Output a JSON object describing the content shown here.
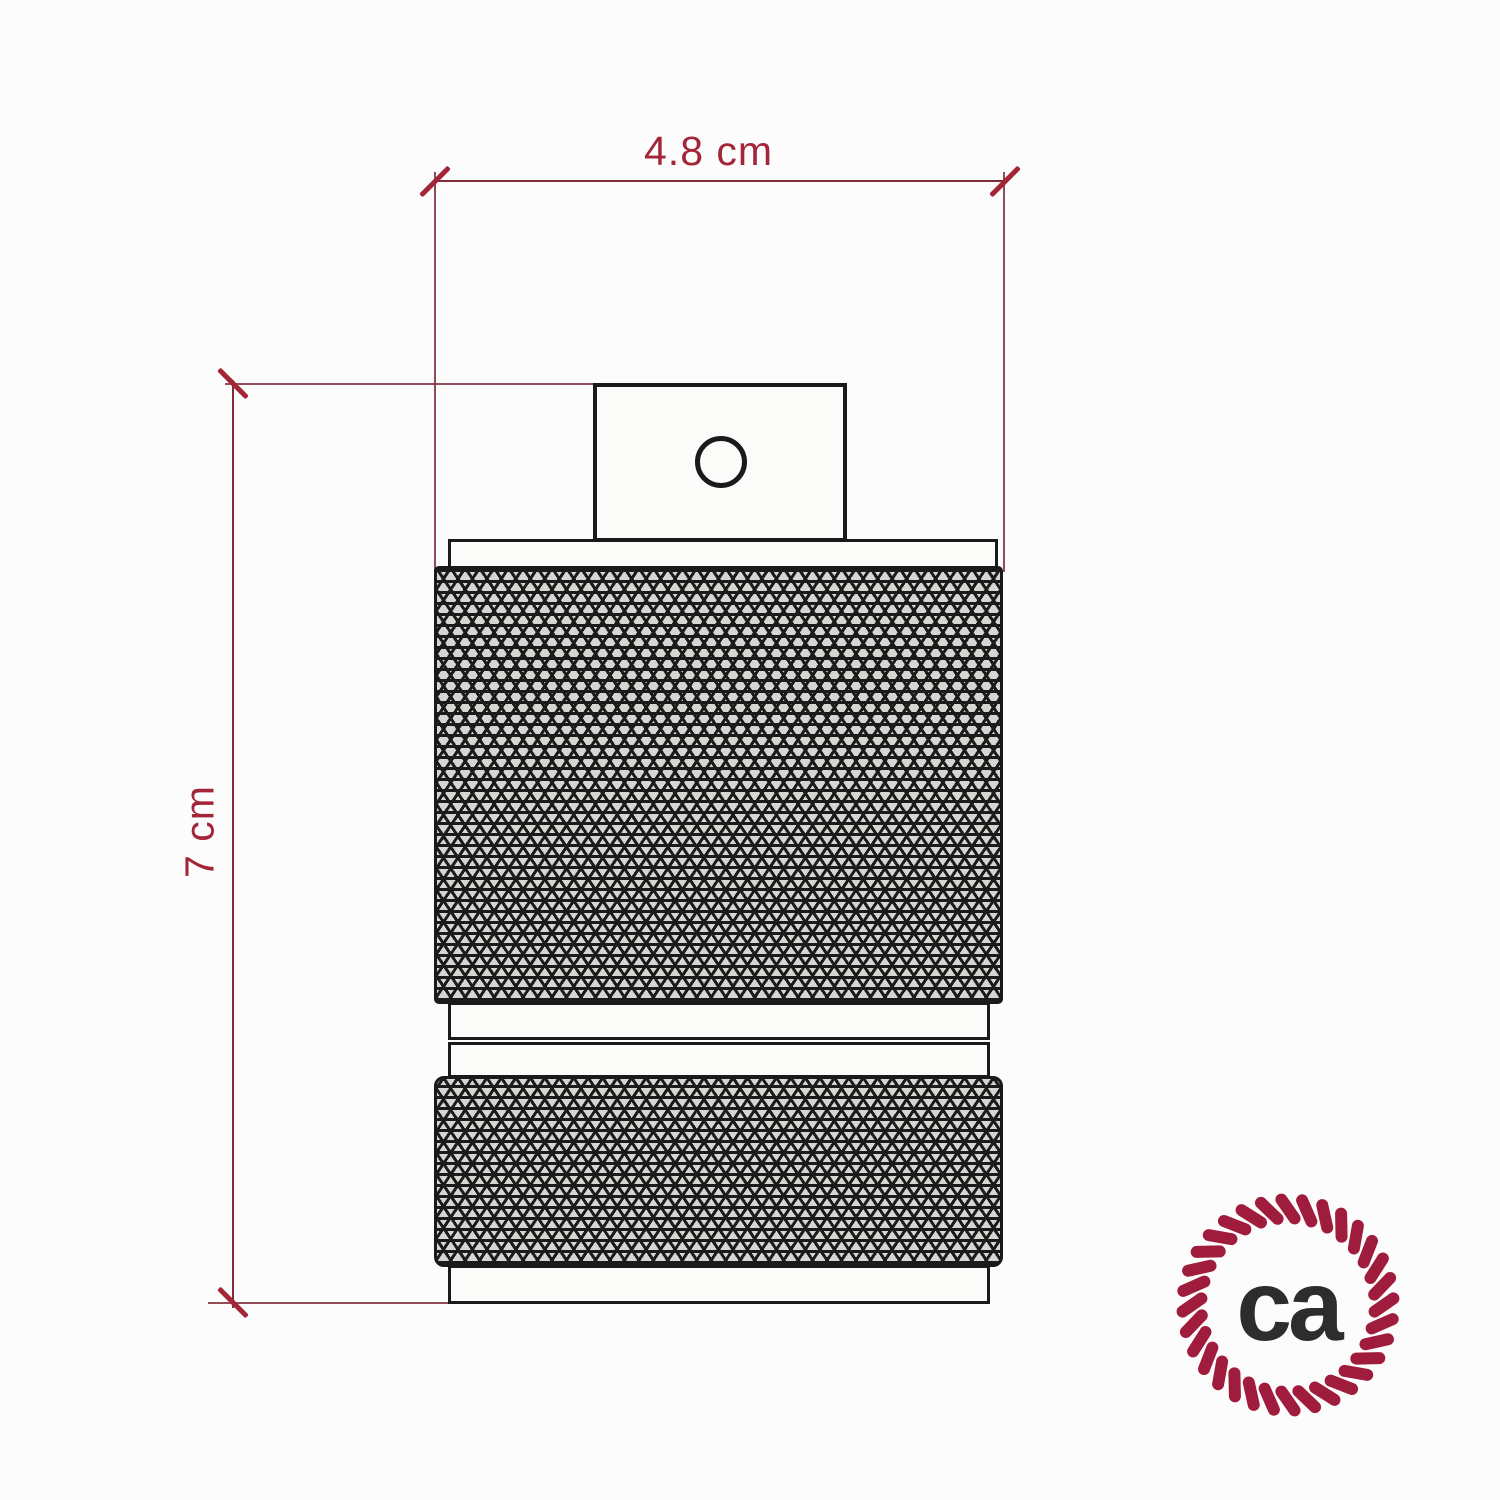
{
  "diagram": {
    "width_dimension": {
      "label": "4.8 cm"
    },
    "height_dimension": {
      "label": "7 cm"
    }
  },
  "logo": {
    "text": "ca",
    "icon": "rope-circle-icon"
  },
  "colors": {
    "dimension_accent": "#a32638",
    "dimension_line": "#7e2d39",
    "drawing_line": "#1a1a1a",
    "knurl_line": "#1b1b1b",
    "logo_ring": "#a01c3c",
    "logo_text": "#2d2d2f",
    "background": "#fcfcfc"
  }
}
